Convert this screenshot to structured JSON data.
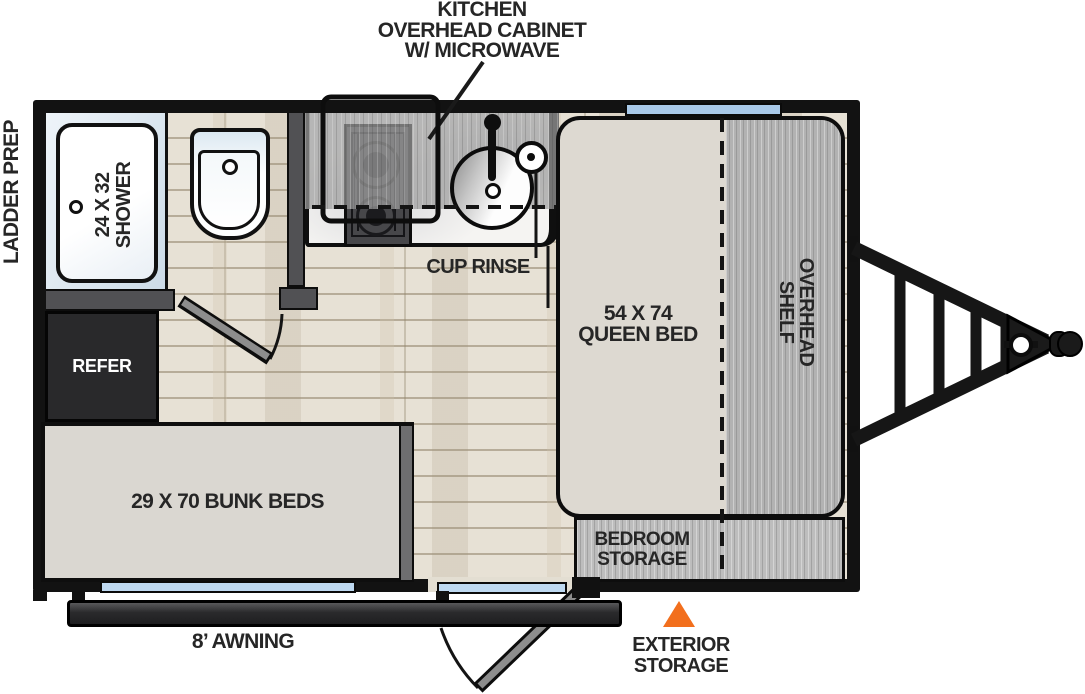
{
  "labels": {
    "callout": [
      "KITCHEN",
      "OVERHEAD CABINET",
      "W/ MICROWAVE"
    ],
    "ladder_prep": "LADDER PREP",
    "shower": [
      "24 X 32",
      "SHOWER"
    ],
    "cup_rinse": "CUP RINSE",
    "refer": "REFER",
    "queen_bed": [
      "54 X 74",
      "QUEEN BED"
    ],
    "overhead_shelf": [
      "OVERHEAD",
      "SHELF"
    ],
    "bunk_beds": "29 X 70 BUNK BEDS",
    "bedroom_storage": [
      "BEDROOM",
      "STORAGE"
    ],
    "awning": "8’ AWNING",
    "exterior_storage": [
      "EXTERIOR",
      "STORAGE"
    ]
  },
  "colors": {
    "wall_black": "#121212",
    "interior_wall_gray": "#515154",
    "wood_floor": "#E7E1D5",
    "cabinet_wood_gray": "#B2B2B2",
    "bed_fill": "#DDD9D1",
    "bunk_fill": "#DAD7D1",
    "refer_dark": "#29292B",
    "window_blue": "#A9C9E9",
    "accent_orange": "#F26F1D"
  }
}
